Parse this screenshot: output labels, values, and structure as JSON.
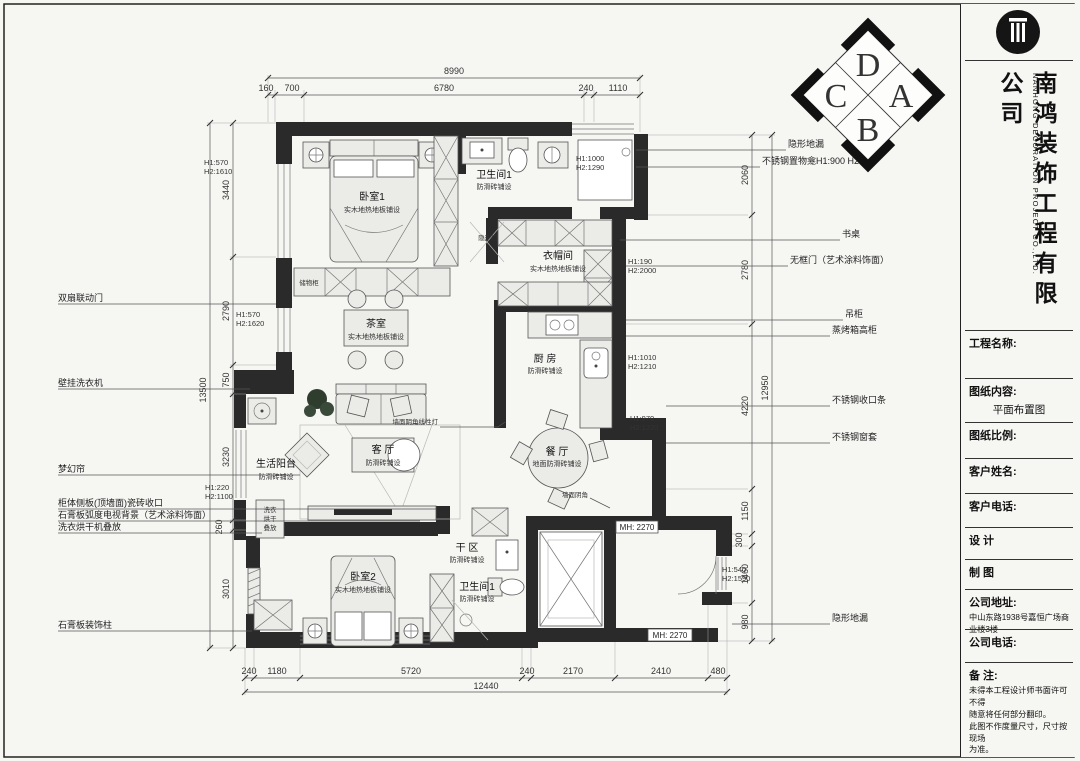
{
  "compass": {
    "top": "D",
    "right": "A",
    "bottom": "B",
    "left": "C"
  },
  "dims": {
    "top": {
      "overall": "8990",
      "s": [
        "160",
        "700",
        "6780",
        "240",
        "1110"
      ]
    },
    "bottom": {
      "overall": "12440",
      "s": [
        "240",
        "1180",
        "5720",
        "240",
        "2170",
        "2410",
        "480"
      ]
    },
    "left": {
      "overall": "13500",
      "s": [
        "3440",
        "2790",
        "750",
        "3230",
        "260",
        "3010"
      ]
    },
    "right": {
      "overall": "12950",
      "s": [
        "2060",
        "2780",
        "4220",
        "1150",
        "300",
        "1460",
        "980"
      ]
    }
  },
  "rooms": {
    "bedroom1": {
      "name": "卧室1",
      "note": "实木地热地板铺设"
    },
    "bath1": {
      "name": "卫生间1",
      "note": "防滑砖铺设"
    },
    "cloakroom": {
      "name": "衣帽间",
      "note": "实木地热地板铺设"
    },
    "tearoom": {
      "name": "茶室",
      "note": "实木地热地板铺设"
    },
    "kitchen": {
      "name": "厨 房",
      "note": "防滑砖铺设"
    },
    "living": {
      "name": "客 厅",
      "note": "防滑砖铺设"
    },
    "dining": {
      "name": "餐 厅",
      "note": "地面防滑砖铺设"
    },
    "balcony": {
      "name": "生活阳台",
      "note": "防滑砖铺设"
    },
    "bedroom2": {
      "name": "卧室2",
      "note": "实木地热地板铺设"
    },
    "dryzone": {
      "name": "干 区",
      "note": "防滑砖铺设"
    },
    "bath2": {
      "name": "卫生间1",
      "note": "防滑砖铺设"
    }
  },
  "notes_left": [
    "双扇联动门",
    "壁挂洗衣机",
    "梦幻帘",
    "柜体侧板(顶墙面)瓷砖收口",
    "石膏板弧度电视背景（艺术涂料饰面）",
    "洗衣烘干机叠放",
    "石膏板装饰柱"
  ],
  "notes_right": [
    "隐形地漏",
    "不锈钢置物龛H1:900 H2:500",
    "书桌",
    "无框门（艺术涂料饰面）",
    "吊柜",
    "蒸烤箱高柜",
    "不锈钢收口条",
    "不锈钢窗套",
    "隐形地漏"
  ],
  "h_labels": [
    [
      "H1:570",
      "H2:1610"
    ],
    [
      "H1:1000",
      "H2:1290"
    ],
    [
      "H1:190",
      "H2:2000"
    ],
    [
      "H1:570",
      "H2:1620"
    ],
    [
      "H1:1010",
      "H2:1210"
    ],
    [
      "H1:970",
      "H2:1220"
    ],
    [
      "H1:220",
      "H2:1100"
    ],
    [
      "H1:540",
      "H2:1590"
    ]
  ],
  "small_labels": {
    "mh1": "MH: 2270",
    "mh2": "MH: 2270",
    "hidden_door": "隐形门",
    "corner_light": "墙面阴角线性灯",
    "wall_corner": "墙面阴角",
    "storage": "储物柜",
    "stack_1": "洗衣",
    "stack_2": "烘干",
    "stack_3": "叠放"
  },
  "title_block": {
    "company_cn": "南鸿装饰工程有限公司",
    "company_en": "NANHONG DECORATION PROJECT CO.,LTD.",
    "project_name_label": "工程名称:",
    "content_label": "图纸内容:",
    "content_value": "平面布置图",
    "scale_label": "图纸比例:",
    "client_name_label": "客户姓名:",
    "client_phone_label": "客户电话:",
    "design_label": "设  计",
    "draft_label": "制  图",
    "address_label": "公司地址:",
    "address_value": "中山东路1938号嘉恒广场商业楼3楼",
    "company_phone_label": "公司电话:",
    "remark_label": "备  注:",
    "remark_line1": "未得本工程设计师书面许可不得",
    "remark_line2": "随意将任何部分翻印。",
    "remark_line3": "此图不作度量尺寸，尺寸按现场",
    "remark_line4": "为准。"
  }
}
